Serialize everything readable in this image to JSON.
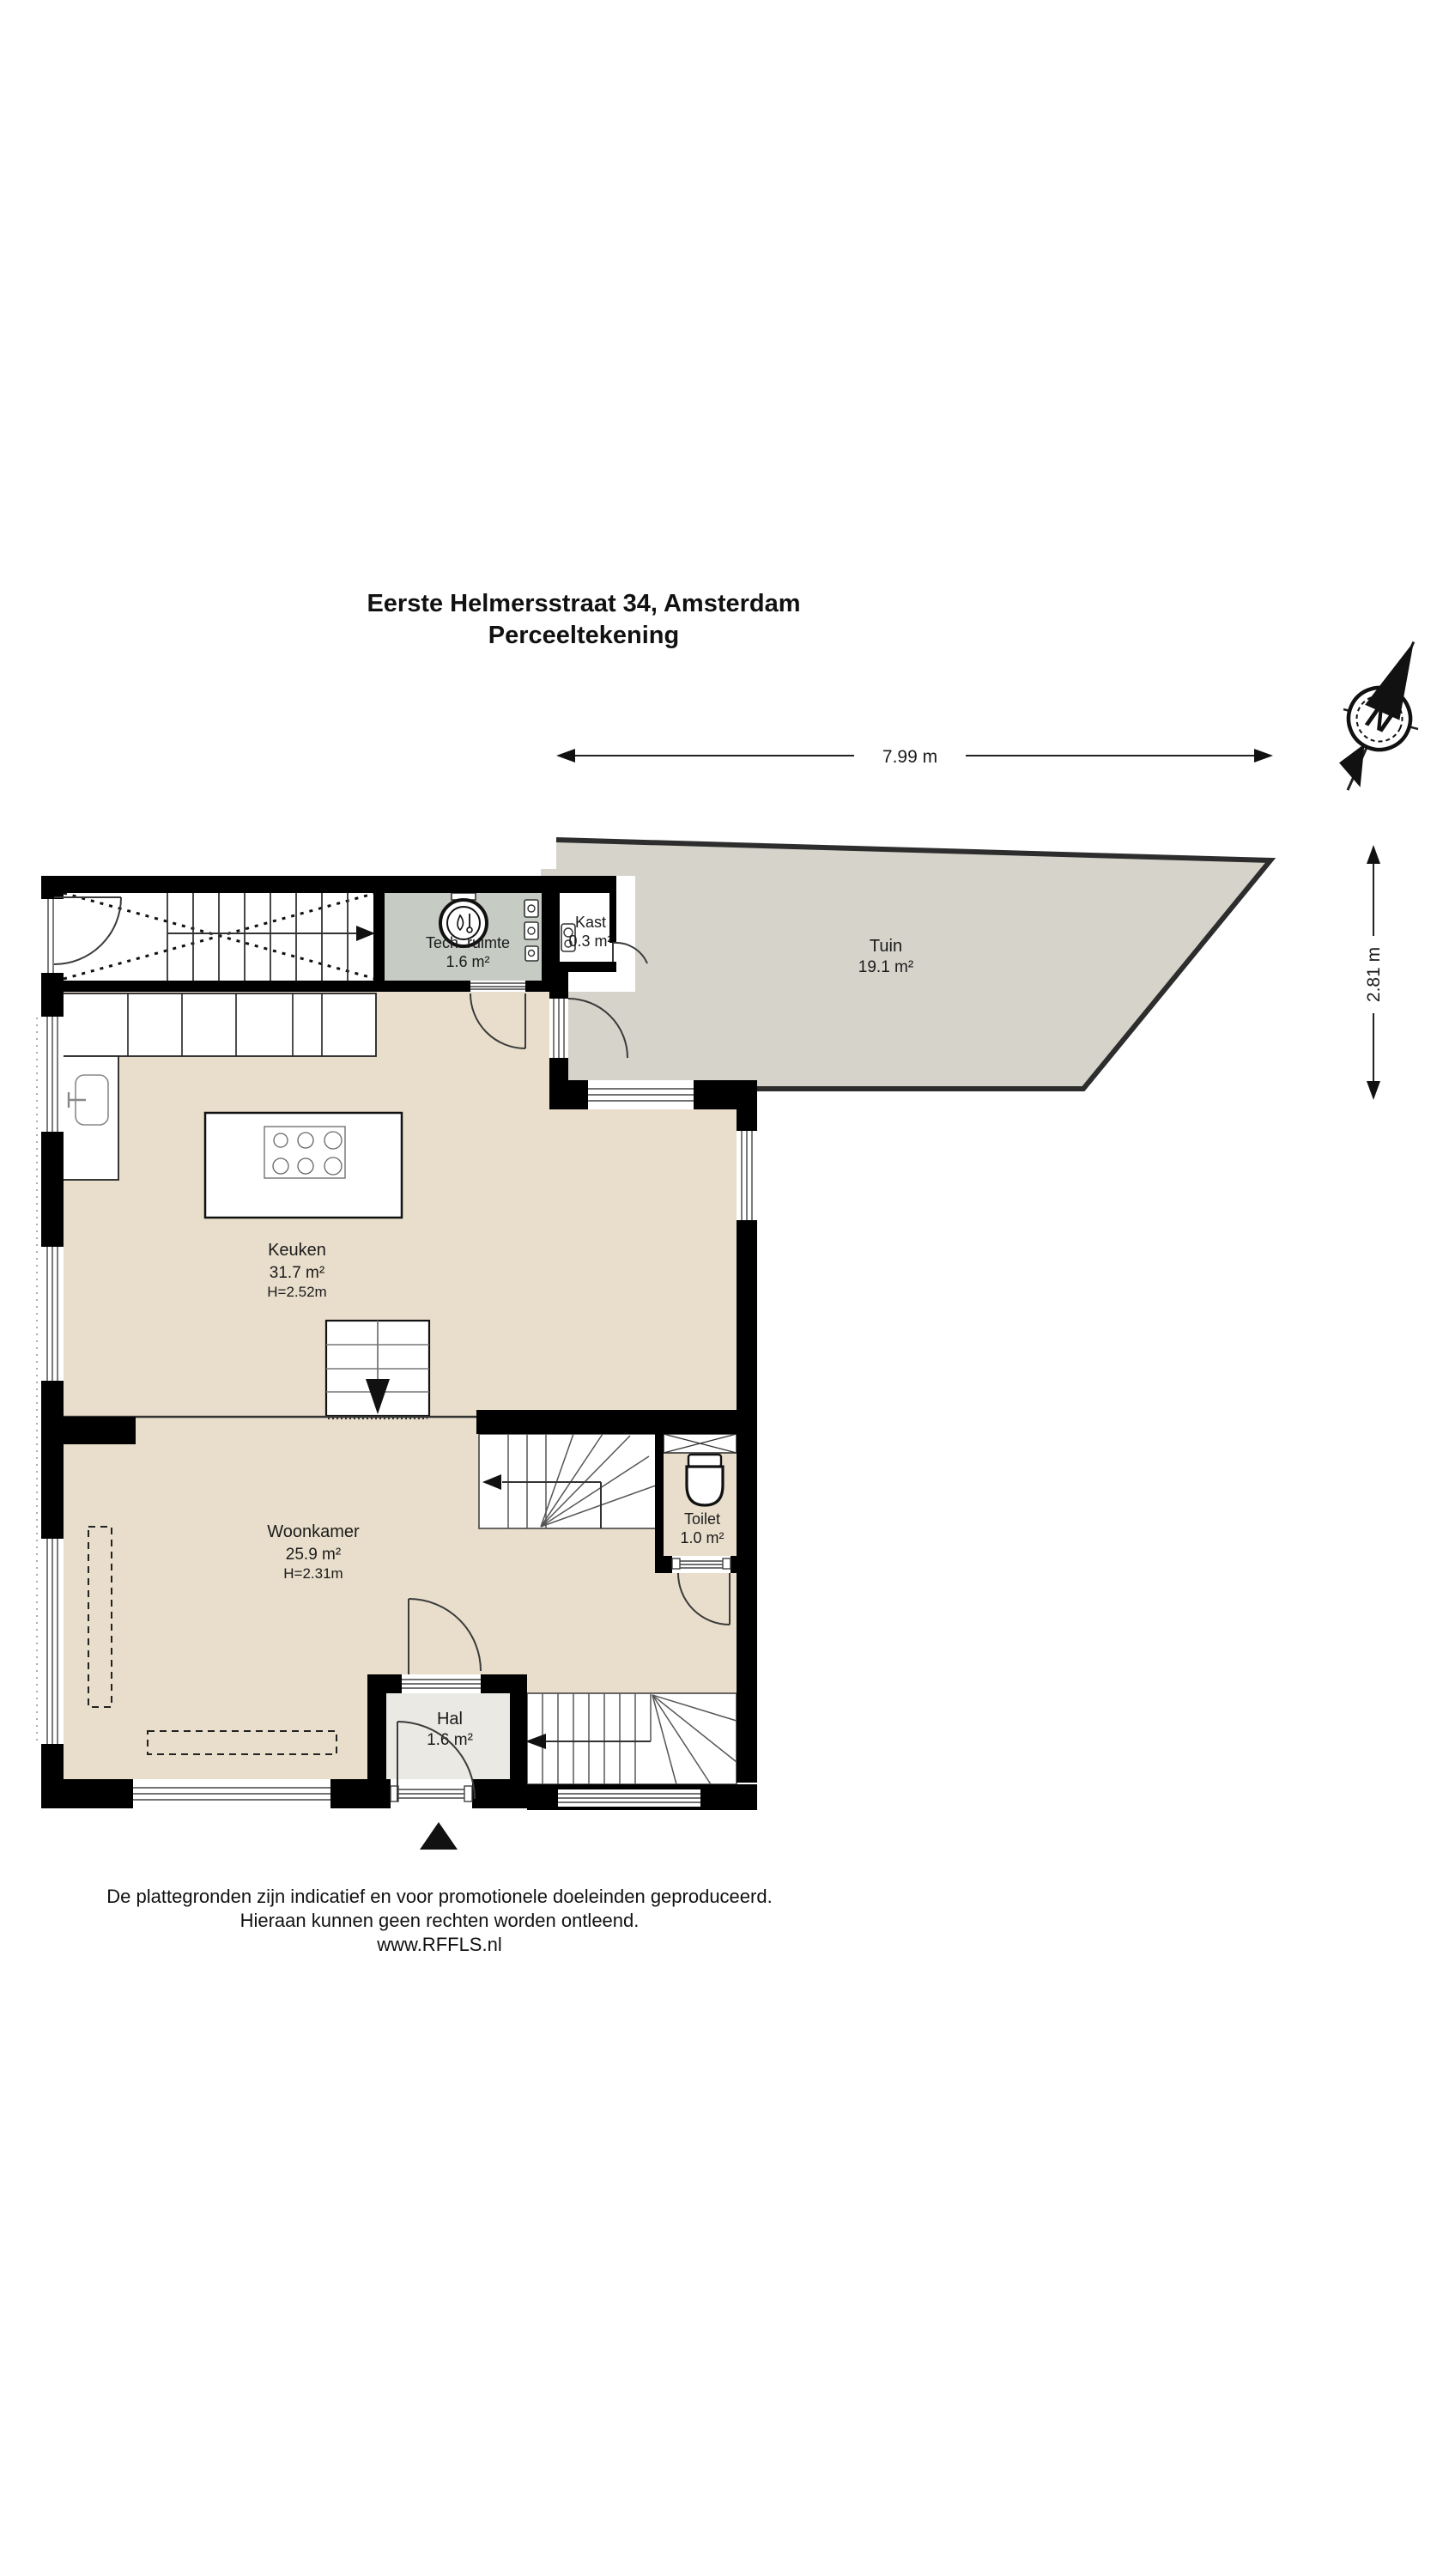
{
  "title": {
    "line1": "Eerste Helmersstraat 34, Amsterdam",
    "line2": "Perceeltekening"
  },
  "compass": {
    "north_label": "N"
  },
  "dimensions": {
    "width_label": "7.99 m",
    "height_label": "2.81 m"
  },
  "rooms": {
    "tech_ruimte": {
      "name": "Tech. ruimte",
      "area": "1.6 m²"
    },
    "kast": {
      "name": "Kast",
      "area": "0.3 m²"
    },
    "tuin": {
      "name": "Tuin",
      "area": "19.1 m²"
    },
    "keuken": {
      "name": "Keuken",
      "area": "31.7 m²",
      "ceiling": "H=2.52m"
    },
    "woonkamer": {
      "name": "Woonkamer",
      "area": "25.9 m²",
      "ceiling": "H=2.31m"
    },
    "toilet": {
      "name": "Toilet",
      "area": "1.0 m²"
    },
    "hal": {
      "name": "Hal",
      "area": "1.6 m²"
    }
  },
  "footer": {
    "line1": "De plattegronden zijn indicatief en voor promotionele doeleinden geproduceerd.",
    "line2": "Hieraan kunnen geen rechten worden ontleend.",
    "line3": "www.RFFLS.nl"
  },
  "colors": {
    "wall": "#000000",
    "floor_beige": "#e8decb",
    "tuin_gray": "#d5d3ca",
    "tech_gray": "#c6cbc4",
    "hal_gray": "#eae9e4",
    "fence": "#2d2d2d"
  }
}
